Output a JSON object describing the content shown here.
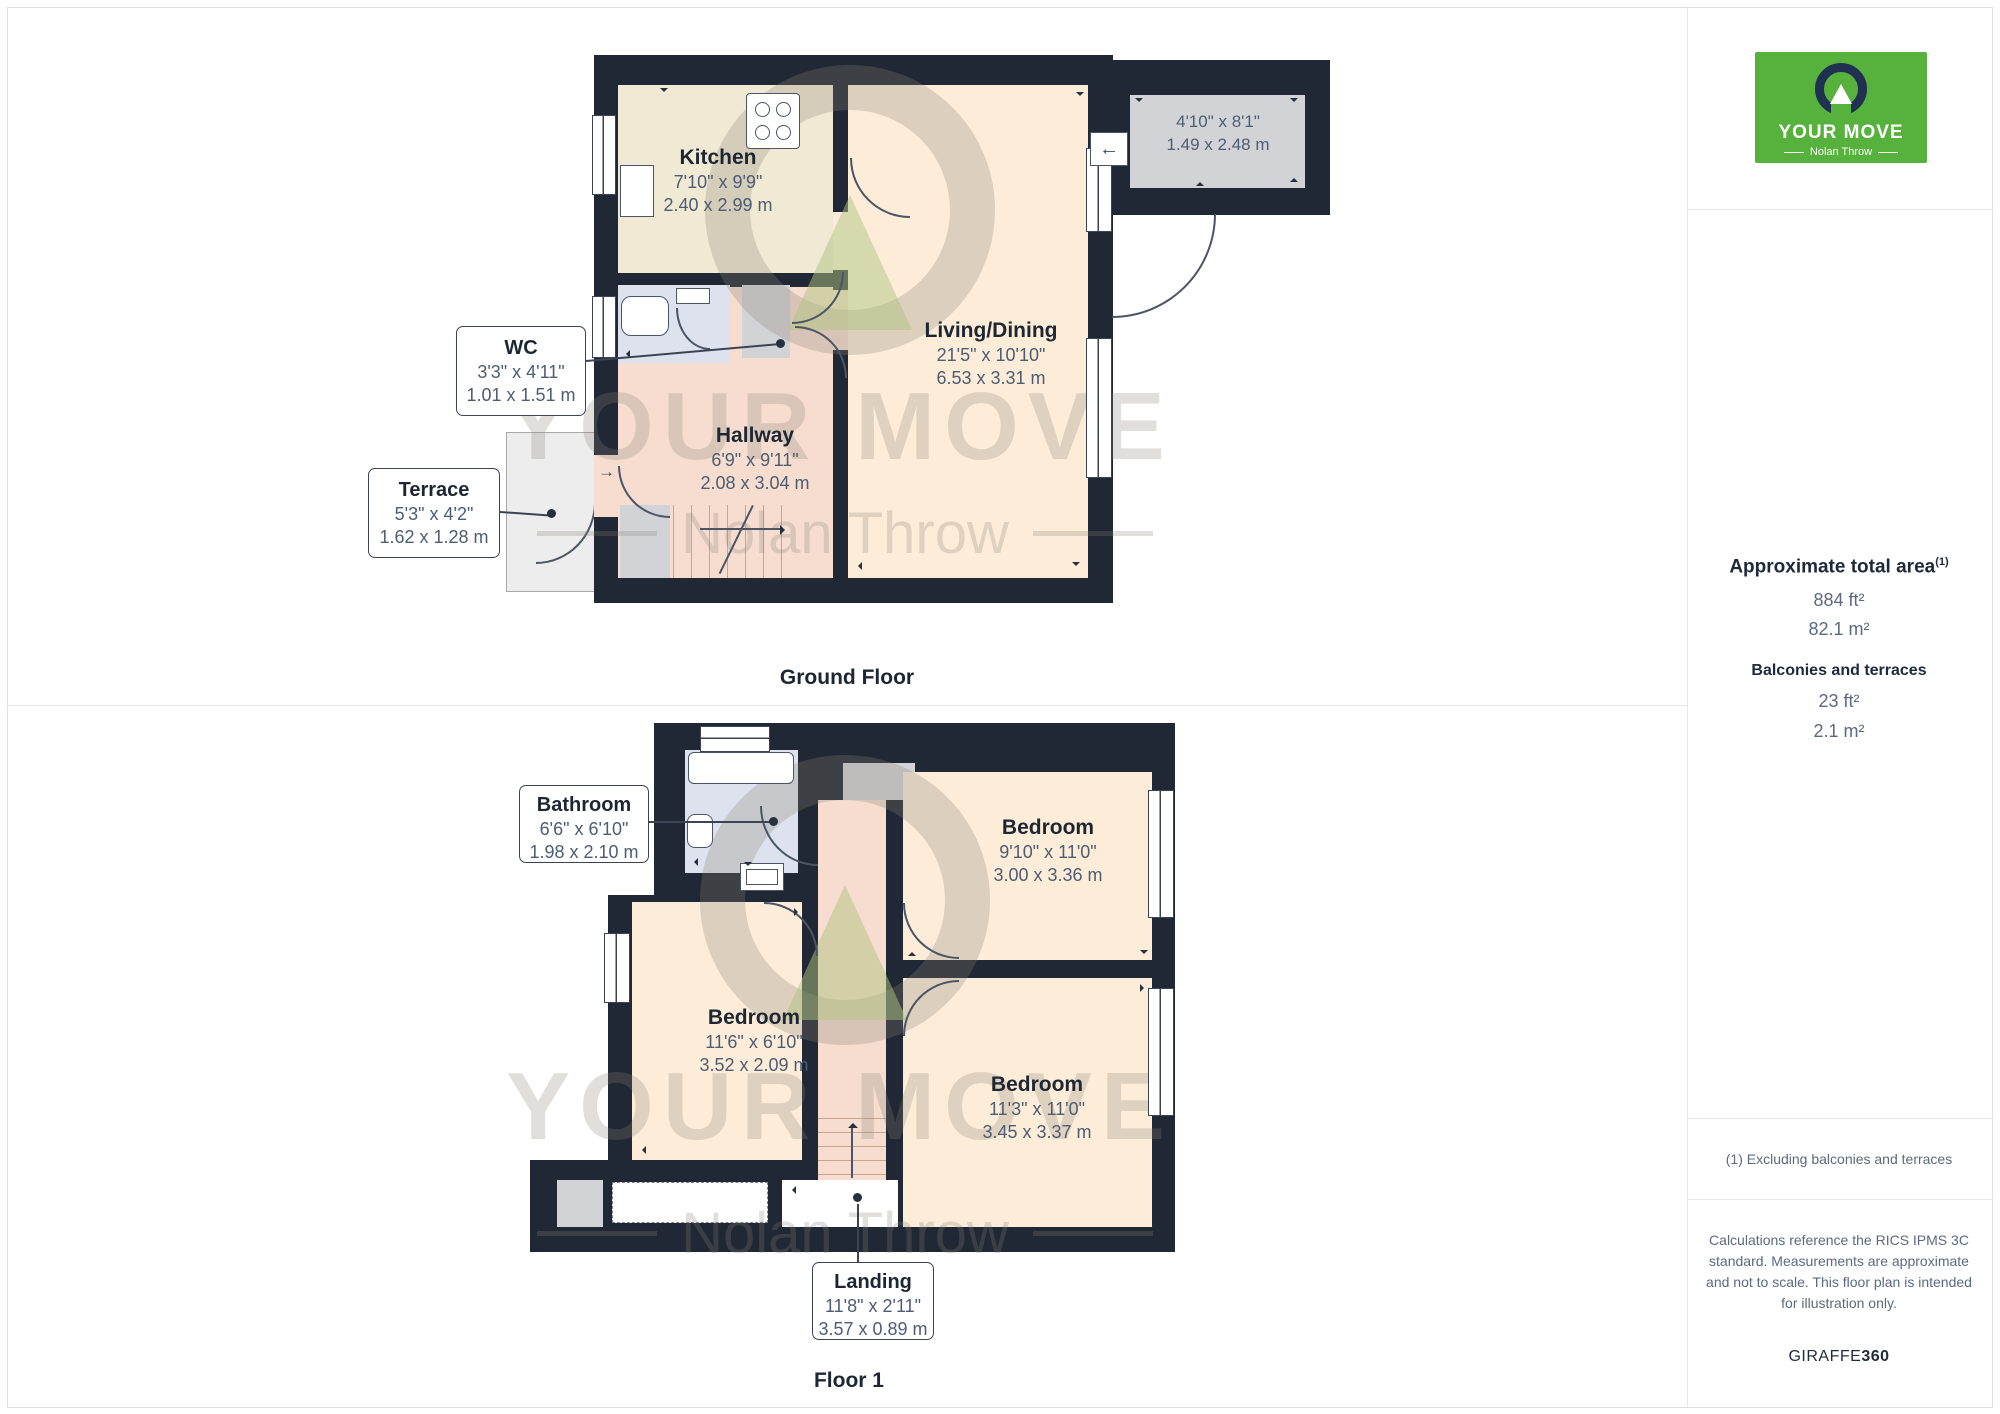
{
  "page": {
    "ground_title": "Ground Floor",
    "floor1_title": "Floor 1"
  },
  "watermark": {
    "brand": "YOUR MOVE",
    "sub": "Nolan Throw"
  },
  "icons": {
    "arrow_left": "←",
    "arrow_right": "→"
  },
  "ground": {
    "kitchen": {
      "name": "Kitchen",
      "imp": "7'10\" x 9'9\"",
      "met": "2.40 x 2.99 m"
    },
    "living": {
      "name": "Living/Dining",
      "imp": "21'5\" x 10'10\"",
      "met": "6.53 x 3.31 m"
    },
    "hallway": {
      "name": "Hallway",
      "imp": "6'9\" x 9'11\"",
      "met": "2.08 x 3.04 m"
    },
    "garage": {
      "imp": "4'10\" x 8'1\"",
      "met": "1.49 x 2.48 m"
    },
    "wc": {
      "name": "WC",
      "imp": "3'3\" x 4'11\"",
      "met": "1.01 x 1.51 m"
    },
    "terrace": {
      "name": "Terrace",
      "imp": "5'3\" x 4'2\"",
      "met": "1.62 x 1.28 m"
    }
  },
  "floor1": {
    "bathroom": {
      "name": "Bathroom",
      "imp": "6'6\" x 6'10\"",
      "met": "1.98 x 2.10 m"
    },
    "bedroom_top": {
      "name": "Bedroom",
      "imp": "9'10\" x 11'0\"",
      "met": "3.00 x 3.36 m"
    },
    "bedroom_left": {
      "name": "Bedroom",
      "imp": "11'6\" x 6'10\"",
      "met": "3.52 x 2.09 m"
    },
    "bedroom_bottom": {
      "name": "Bedroom",
      "imp": "11'3\" x 11'0\"",
      "met": "3.45 x 3.37 m"
    },
    "landing": {
      "name": "Landing",
      "imp": "11'8\" x 2'11\"",
      "met": "3.57 x 0.89 m"
    }
  },
  "sidebar": {
    "logo": {
      "brand": "YOUR MOVE",
      "sub": "Nolan Throw"
    },
    "area": {
      "heading": "Approximate total area",
      "sup": "(1)",
      "ft": "884 ft²",
      "m": "82.1 m²"
    },
    "balconies": {
      "heading": "Balconies and terraces",
      "ft": "23 ft²",
      "m": "2.1 m²"
    },
    "footnote": "(1) Excluding balconies and terraces",
    "disclaimer": "Calculations reference the RICS IPMS 3C standard. Measurements are approximate and not to scale. This floor plan is intended for illustration only.",
    "credit": {
      "normal": "GIRAFFE",
      "bold": "360"
    }
  },
  "colors": {
    "wall": "#1f2834",
    "kitchen_floor": "#f0e9d4",
    "living_floor": "#fcecd8",
    "hall_floor": "#f6ddcf",
    "bath_floor": "#dde2ee",
    "closet_gray": "#d2d3d7",
    "terrace_gray": "#ededed",
    "brand_green": "#56b23c",
    "logo_navy": "#1f3050",
    "text_dark": "#1d2734",
    "text_slate": "#4d5d74"
  }
}
